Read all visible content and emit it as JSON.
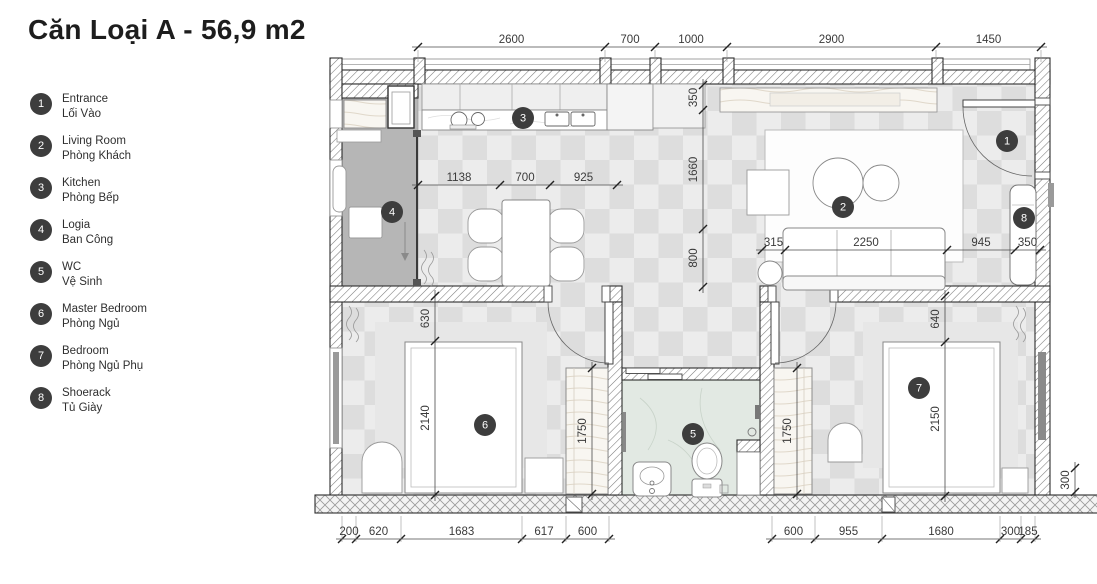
{
  "title": "Căn Loại A - 56,9 m2",
  "legend": [
    {
      "n": "1",
      "en": "Entrance",
      "vi": "Lối Vào",
      "slug": "entrance"
    },
    {
      "n": "2",
      "en": "Living Room",
      "vi": "Phòng Khách",
      "slug": "living-room"
    },
    {
      "n": "3",
      "en": "Kitchen",
      "vi": "Phòng Bếp",
      "slug": "kitchen"
    },
    {
      "n": "4",
      "en": "Logia",
      "vi": "Ban Công",
      "slug": "logia"
    },
    {
      "n": "5",
      "en": "WC",
      "vi": "Vệ Sinh",
      "slug": "wc"
    },
    {
      "n": "6",
      "en": "Master Bedroom",
      "vi": "Phòng Ngủ",
      "slug": "master-bedroom"
    },
    {
      "n": "7",
      "en": "Bedroom",
      "vi": "Phòng Ngủ Phụ",
      "slug": "bedroom"
    },
    {
      "n": "8",
      "en": "Shoerack",
      "vi": "Tủ Giày",
      "slug": "shoerack"
    }
  ],
  "plan": {
    "colors": {
      "badge": "#3d3d3d",
      "dim_text": "#3a3a3a",
      "wall_line": "#2d2d2d"
    },
    "badges": [
      {
        "n": "1",
        "x": 1007,
        "y": 141
      },
      {
        "n": "2",
        "x": 843,
        "y": 207
      },
      {
        "n": "3",
        "x": 523,
        "y": 118
      },
      {
        "n": "4",
        "x": 392,
        "y": 212
      },
      {
        "n": "5",
        "x": 693,
        "y": 434
      },
      {
        "n": "6",
        "x": 485,
        "y": 425
      },
      {
        "n": "7",
        "x": 919,
        "y": 388
      },
      {
        "n": "8",
        "x": 1024,
        "y": 218
      }
    ],
    "dim_lines": [
      {
        "id": "top-wall",
        "dir": "h",
        "pos": 47,
        "ticks": [
          418,
          605,
          655,
          727,
          936,
          1041
        ],
        "labels": [
          "2600",
          "700",
          "1000",
          "2900",
          "1450"
        ],
        "ext_to": 62
      },
      {
        "id": "kitchen-dining",
        "dir": "h",
        "pos": 185,
        "ticks": [
          418,
          500,
          550,
          617
        ],
        "labels": [
          "1138",
          "700",
          "925"
        ]
      },
      {
        "id": "sofa-line",
        "dir": "h",
        "pos": 250,
        "ticks": [
          762,
          785,
          947,
          1015,
          1040
        ],
        "labels": [
          "315",
          "2250",
          "945",
          "350"
        ]
      },
      {
        "id": "hall-vertical",
        "dir": "v",
        "pos": 703,
        "ticks": [
          85,
          110,
          229,
          287
        ],
        "labels": [
          "350",
          "1660",
          "800"
        ]
      },
      {
        "id": "bed-master",
        "dir": "v",
        "pos": 435,
        "ticks": [
          296,
          341,
          495
        ],
        "labels": [
          "630",
          "2140"
        ]
      },
      {
        "id": "wardrobe-master",
        "dir": "v",
        "pos": 592,
        "ticks": [
          368,
          494
        ],
        "labels": [
          "1750"
        ]
      },
      {
        "id": "bed-second",
        "dir": "v",
        "pos": 945,
        "ticks": [
          296,
          342,
          496
        ],
        "labels": [
          "640",
          "2150"
        ]
      },
      {
        "id": "wardrobe-second",
        "dir": "v",
        "pos": 797,
        "ticks": [
          368,
          494
        ],
        "labels": [
          "1750"
        ]
      },
      {
        "id": "bottom-left",
        "dir": "h",
        "pos": 539,
        "ticks": [
          342,
          356,
          401,
          522,
          566,
          609
        ],
        "labels": [
          "200",
          "620",
          "1683",
          "617",
          "600"
        ],
        "ext_from": 516
      },
      {
        "id": "bottom-right",
        "dir": "h",
        "pos": 539,
        "ticks": [
          772,
          815,
          882,
          1000,
          1021,
          1035
        ],
        "labels": [
          "600",
          "955",
          "1680",
          "300",
          "185"
        ],
        "ext_from": 516
      },
      {
        "id": "right-side",
        "dir": "v",
        "pos": 1075,
        "ticks": [
          468,
          492
        ],
        "labels": [
          "300"
        ]
      }
    ]
  }
}
